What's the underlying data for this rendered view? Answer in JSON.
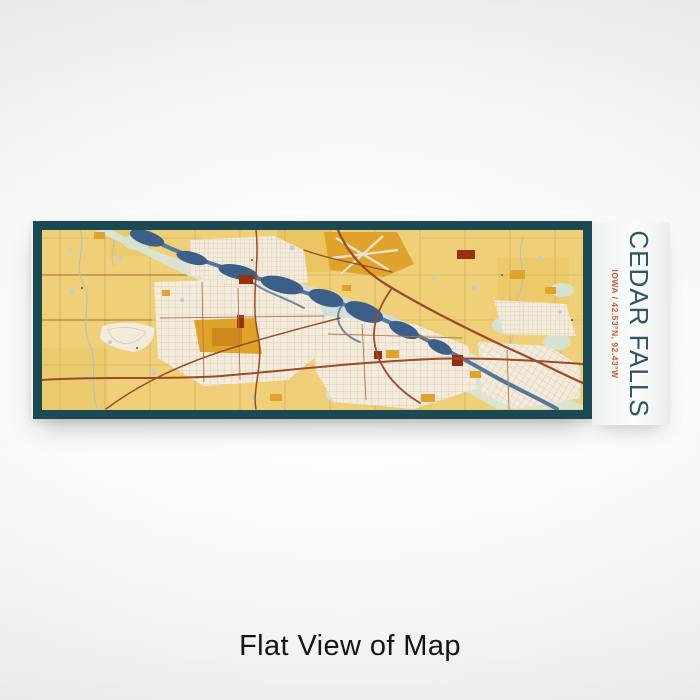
{
  "wrap_label": {
    "title": "CEDAR FALLS",
    "subtitle": "IOWA / 42.53°N, 92.43°W"
  },
  "scene": {
    "caption": "Flat View of Map"
  },
  "map": {
    "place": "Cedar Falls, Iowa",
    "colors": {
      "frame_teal": "#1b4a55",
      "land_yellow": "#efd078",
      "deep_yellow": "#e9c45e",
      "urban_cream": "#f3ecdc",
      "street_line": "#d9c2a9",
      "floodplain_sage": "#dbe4d1",
      "wetland_blue_green": "#cfdeda",
      "river_blue": "#53789c",
      "lake_deep_blue": "#3b5f89",
      "highway_rust": "#9b4b27",
      "landuse_orange": "#dfa22b",
      "landuse_dark_red": "#992f0c",
      "title_text_teal": "#2b5a63",
      "subtitle_text_orange": "#c75f3d"
    }
  }
}
